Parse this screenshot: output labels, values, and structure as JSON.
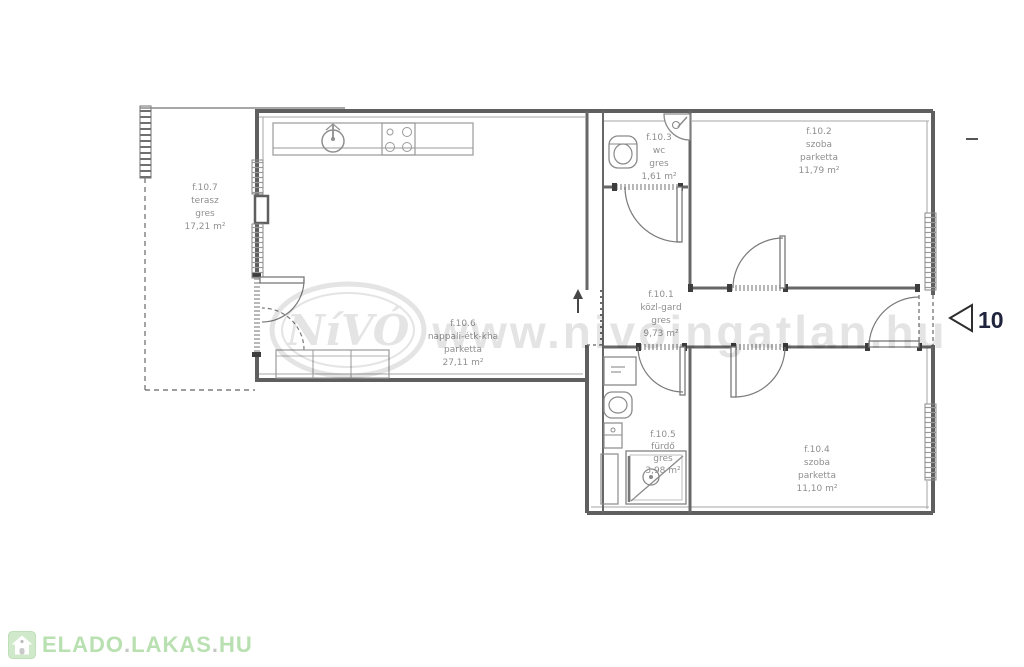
{
  "watermark": {
    "logo": "NíVÓ",
    "url": "www.nivoingatlan.hu"
  },
  "entry_marker": {
    "number": "10"
  },
  "branding": {
    "parts": [
      "ELADO",
      ".",
      "LAKAS",
      ".",
      "HU"
    ]
  },
  "rooms": [
    {
      "id": "f.10.7",
      "name": "terasz",
      "floor": "gres",
      "area": "17,21 m²"
    },
    {
      "id": "f.10.6",
      "name": "nappali-étk-kha",
      "floor": "parketta",
      "area": "27,11 m²"
    },
    {
      "id": "f.10.3",
      "name": "wc",
      "floor": "gres",
      "area": "1,61 m²"
    },
    {
      "id": "f.10.2",
      "name": "szoba",
      "floor": "parketta",
      "area": "11,79 m²"
    },
    {
      "id": "f.10.1",
      "name": "közl-gard",
      "floor": "gres",
      "area": "9,73 m²"
    },
    {
      "id": "f.10.5",
      "name": "fürdő",
      "floor": "gres",
      "area": "3,98 m²"
    },
    {
      "id": "f.10.4",
      "name": "szoba",
      "floor": "parketta",
      "area": "11,10 m²"
    }
  ],
  "colors": {
    "wall": "#5f5f5f",
    "thin_line": "#9a9a9a",
    "label_text": "#8f8f8f",
    "brand_green": "#b9e0b0",
    "marker_text": "#20243c"
  }
}
